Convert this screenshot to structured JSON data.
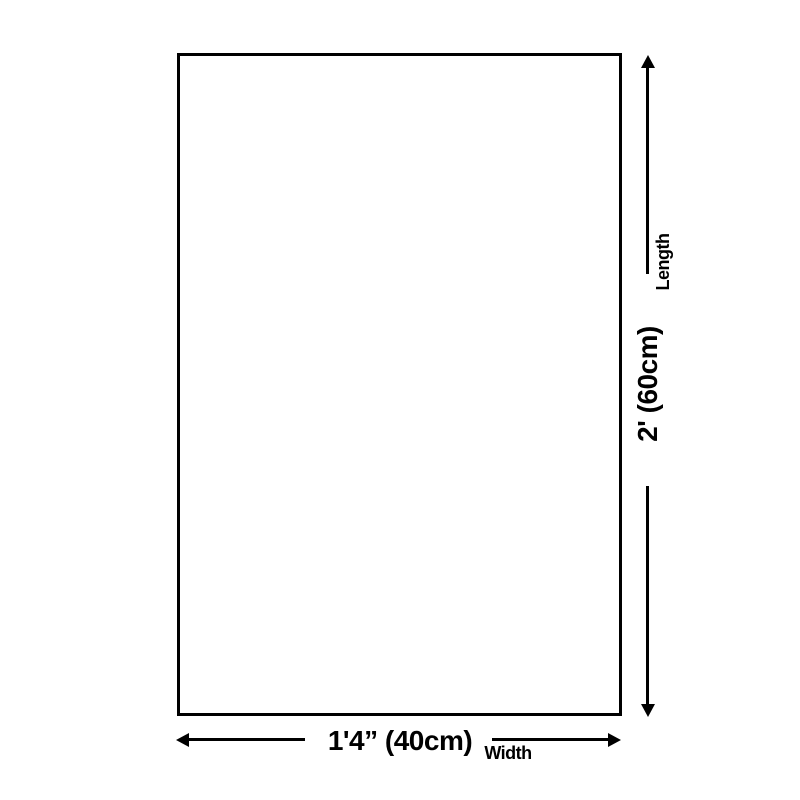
{
  "colors": {
    "background": "#ffffff",
    "line": "#000000",
    "text": "#000000"
  },
  "dimensions": {
    "length": {
      "label": "Length",
      "value": "2' (60cm)"
    },
    "width": {
      "label": "Width",
      "value": "1'4” (40cm)"
    }
  },
  "icons": {
    "length_arrow": "vertical-double-headed-arrow",
    "width_arrow": "horizontal-double-headed-arrow"
  }
}
